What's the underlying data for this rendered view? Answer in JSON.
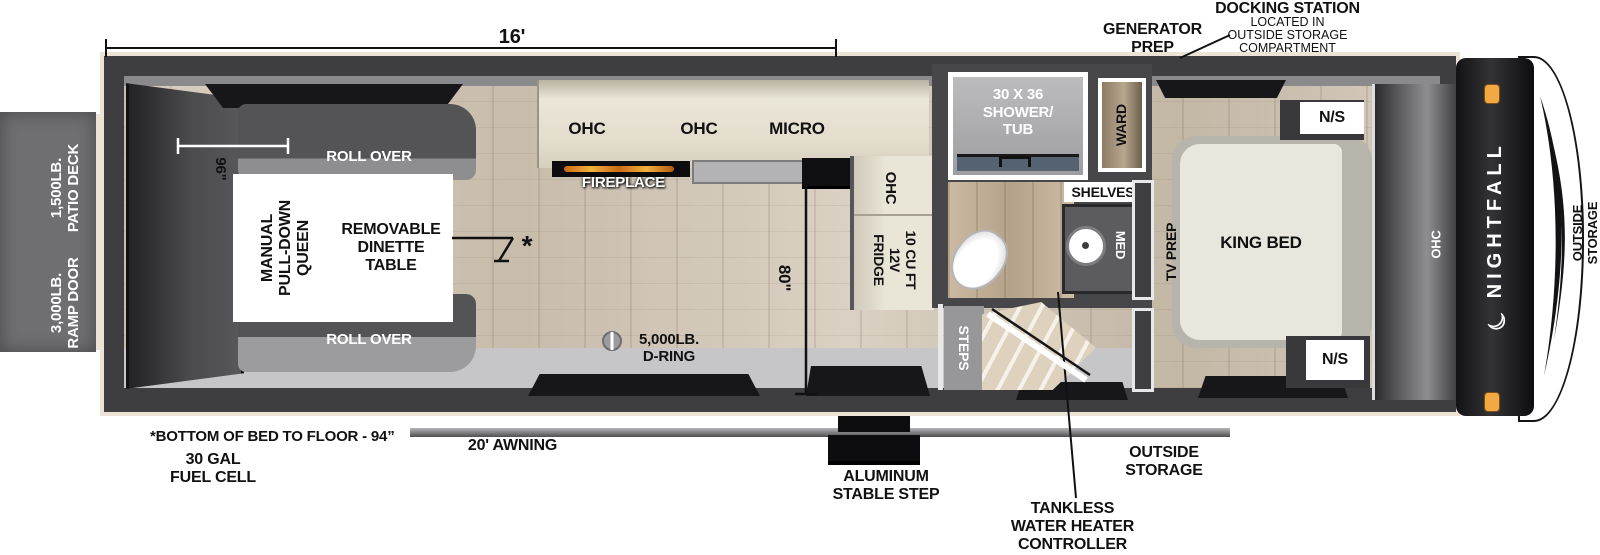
{
  "brand": {
    "name": "NIGHTFALL"
  },
  "icons": {
    "crescent_moon": "☾",
    "table_asterisk": "*",
    "d_ring": "d-ring"
  },
  "dimensions": {
    "overall_length": "16'",
    "garage_width": "96\"",
    "entry_height": "80\""
  },
  "callouts": {
    "generator_prep": "GENERATOR\nPREP",
    "docking_title": "DOCKING STATION",
    "docking_sub": "LOCATED IN\nOUTSIDE STORAGE\nCOMPARTMENT",
    "bed_floor_note": "*BOTTOM OF BED TO FLOOR - 94”",
    "fuel_cell": "30 GAL\nFUEL CELL",
    "awning": "20' AWNING",
    "stable_step": "ALUMINUM\nSTABLE STEP",
    "tankless": "TANKLESS\nWATER HEATER\nCONTROLLER",
    "outside_storage_bottom": "OUTSIDE\nSTORAGE",
    "outside_storage_right": "OUTSIDE\nSTORAGE"
  },
  "exterior": {
    "patio_deck": "1,500LB.\nPATIO DECK",
    "ramp_door": "3,000LB.\nRAMP DOOR"
  },
  "garage": {
    "roll_over_top": "ROLL OVER",
    "roll_over_bottom": "ROLL OVER",
    "queen_bed": "MANUAL\nPULL-DOWN\nQUEEN",
    "dinette": "REMOVABLE\nDINETTE\nTABLE",
    "d_ring": "5,000LB.\nD-RING"
  },
  "kitchen": {
    "ohc_left": "OHC",
    "ohc_mid": "OHC",
    "micro": "MICRO",
    "fireplace": "FIREPLACE",
    "ohc_vertical": "OHC",
    "fridge": "10 CU FT\n12V\nFRIDGE"
  },
  "bath": {
    "shower": "30 X 36\nSHOWER/\nTUB",
    "shelves": "SHELVES",
    "med": "MED",
    "ward": "WARD",
    "steps": "STEPS"
  },
  "bedroom": {
    "tv_prep": "TV PREP",
    "king_bed": "KING BED",
    "ns_top": "N/S",
    "ns_bottom": "N/S",
    "ohc": "OHC"
  }
}
